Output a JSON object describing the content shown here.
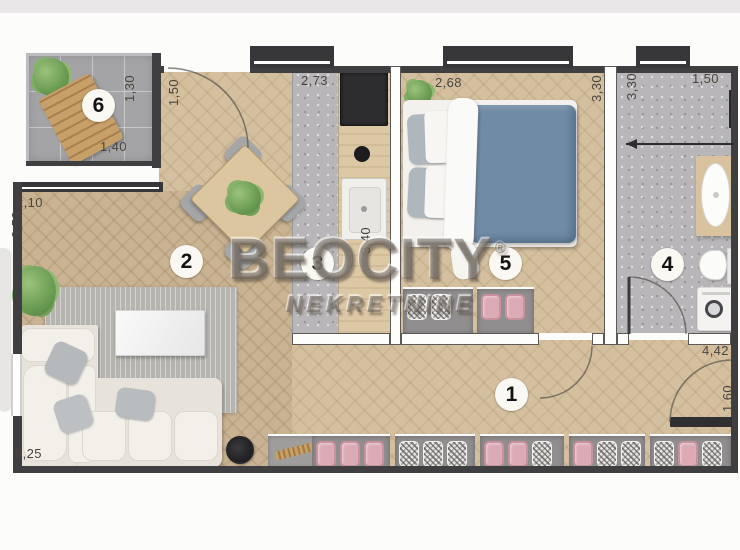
{
  "watermark": {
    "brand": "BEOCITY",
    "registered": "®",
    "subtitle": "NEKRETNINE"
  },
  "rooms": {
    "hallway": {
      "number": "1"
    },
    "living_room": {
      "number": "2"
    },
    "kitchen": {
      "number": "3"
    },
    "bathroom": {
      "number": "4"
    },
    "bedroom": {
      "number": "5"
    },
    "terrace": {
      "number": "6"
    }
  },
  "dimensions": {
    "terrace_depth": "1,30",
    "terrace_width": "1,40",
    "entry_width": "1,50",
    "living_top": "2,10",
    "living_left": "3,53",
    "living_bottom": "9,25",
    "kitchen_top": "2,73",
    "kitchen_right": "3,40",
    "bedroom_top": "2,68",
    "bedroom_right": "3,30",
    "bathroom_left": "3,30",
    "bathroom_top": "1,50",
    "hallway_right": "4,42",
    "entrance_door": "1,60"
  },
  "colors": {
    "wood_floor": "#d4c09f",
    "tile_floor": "#b8b6b8",
    "terrace_tile": "#a4a4a6",
    "wall": "#3f3e40",
    "bed_blanket": "#6f8ba5",
    "accent_pink": "#dcaab4",
    "watermark_gray": "#69635a"
  }
}
